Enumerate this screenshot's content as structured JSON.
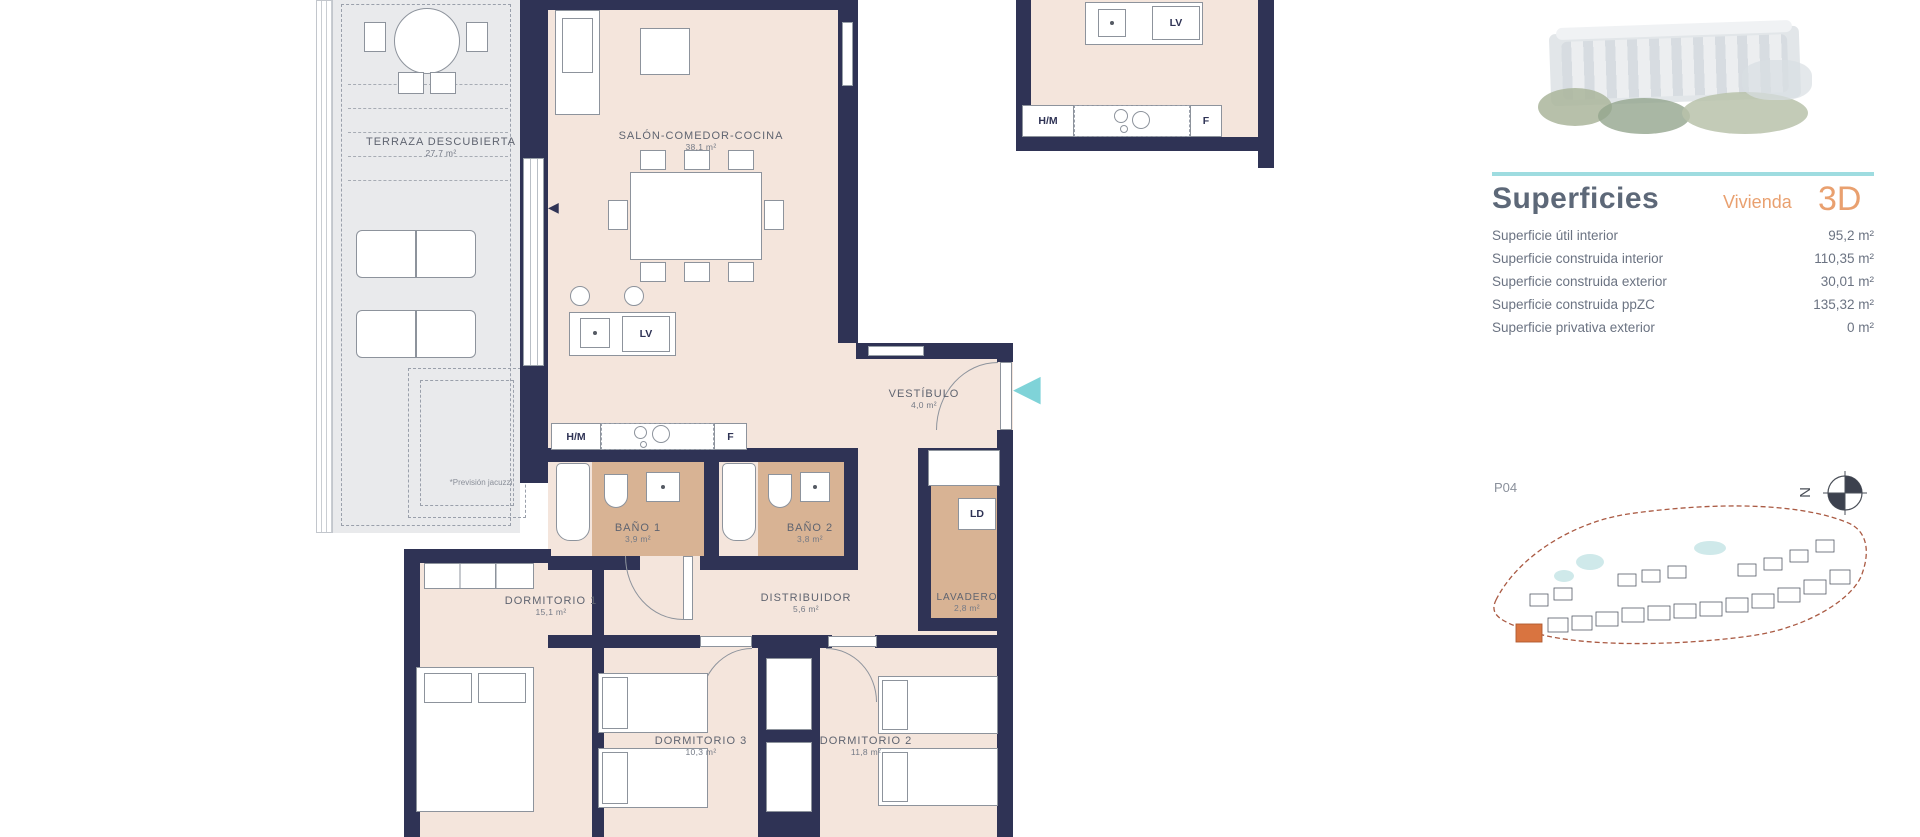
{
  "colors": {
    "wall": "#2f3355",
    "floor": "#f4e5dc",
    "wet_floor": "#d8b394",
    "terrace": "#e9eaec",
    "teal_accent": "#7fd3d8",
    "orange_accent": "#e9a06f",
    "heading_slate": "#5d6878"
  },
  "plan": {
    "rooms": {
      "terraza": {
        "name": "TERRAZA DESCUBIERTA",
        "area": "27,7 m²"
      },
      "salon": {
        "name": "SALÓN-COMEDOR-COCINA",
        "area": "38,1 m²"
      },
      "vestibulo": {
        "name": "VESTÍBULO",
        "area": "4,0 m²"
      },
      "bano1": {
        "name": "BAÑO 1",
        "area": "3,9 m²"
      },
      "bano2": {
        "name": "BAÑO 2",
        "area": "3,8 m²"
      },
      "dormitorio1": {
        "name": "DORMITORIO 1",
        "area": "15,1 m²"
      },
      "distribuidor": {
        "name": "DISTRIBUIDOR",
        "area": "5,6 m²"
      },
      "lavadero": {
        "name": "LAVADERO",
        "area": "2,8 m²"
      },
      "dormitorio3": {
        "name": "DORMITORIO 3",
        "area": "10,3 m²"
      },
      "dormitorio2": {
        "name": "DORMITORIO 2",
        "area": "11,8 m²"
      }
    },
    "appliance_labels": {
      "lv": "LV",
      "hm": "H/M",
      "f": "F",
      "ld": "LD"
    },
    "note_jacuzzi": "*Previsión jacuzzi"
  },
  "panel": {
    "title": "Superficies",
    "subtitle": "Vivienda",
    "unit": "3D",
    "rows": [
      {
        "label": "Superficie útil interior",
        "value": "95,2 m²"
      },
      {
        "label": "Superficie construida interior",
        "value": "110,35 m²"
      },
      {
        "label": "Superficie construida exterior",
        "value": "30,01 m²"
      },
      {
        "label": "Superficie construida ppZC",
        "value": "135,32 m²"
      },
      {
        "label": "Superficie privativa exterior",
        "value": "0 m²"
      }
    ],
    "site_ref": "P04",
    "compass_letter": "N"
  }
}
